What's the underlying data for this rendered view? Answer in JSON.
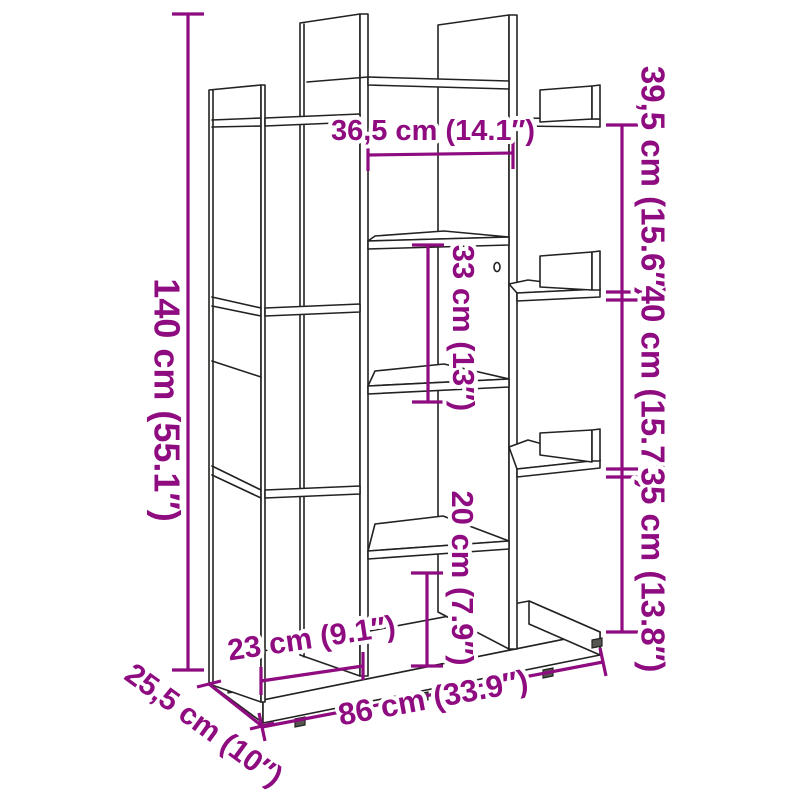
{
  "diagram": {
    "title": "bookcase-dimension-diagram",
    "labels": {
      "height_total": "140 cm (55.1″)",
      "width_inner_top": "36,5 cm (14.1″)",
      "right_upper": "39,5 cm (15.6″)",
      "right_middle": "40 cm (15.7″)",
      "right_lower": "35 cm (13.8″)",
      "inner_upper": "33 cm (13″)",
      "inner_lower": "20 cm (7.9″)",
      "bottom_inner": "23 cm (9.1″)",
      "width_total": "86 cm (33.9″)",
      "depth_total": "25,5 cm (10″)"
    },
    "colors": {
      "dimension": "#8E0B80",
      "line": "#222220",
      "background": "#ffffff"
    }
  }
}
